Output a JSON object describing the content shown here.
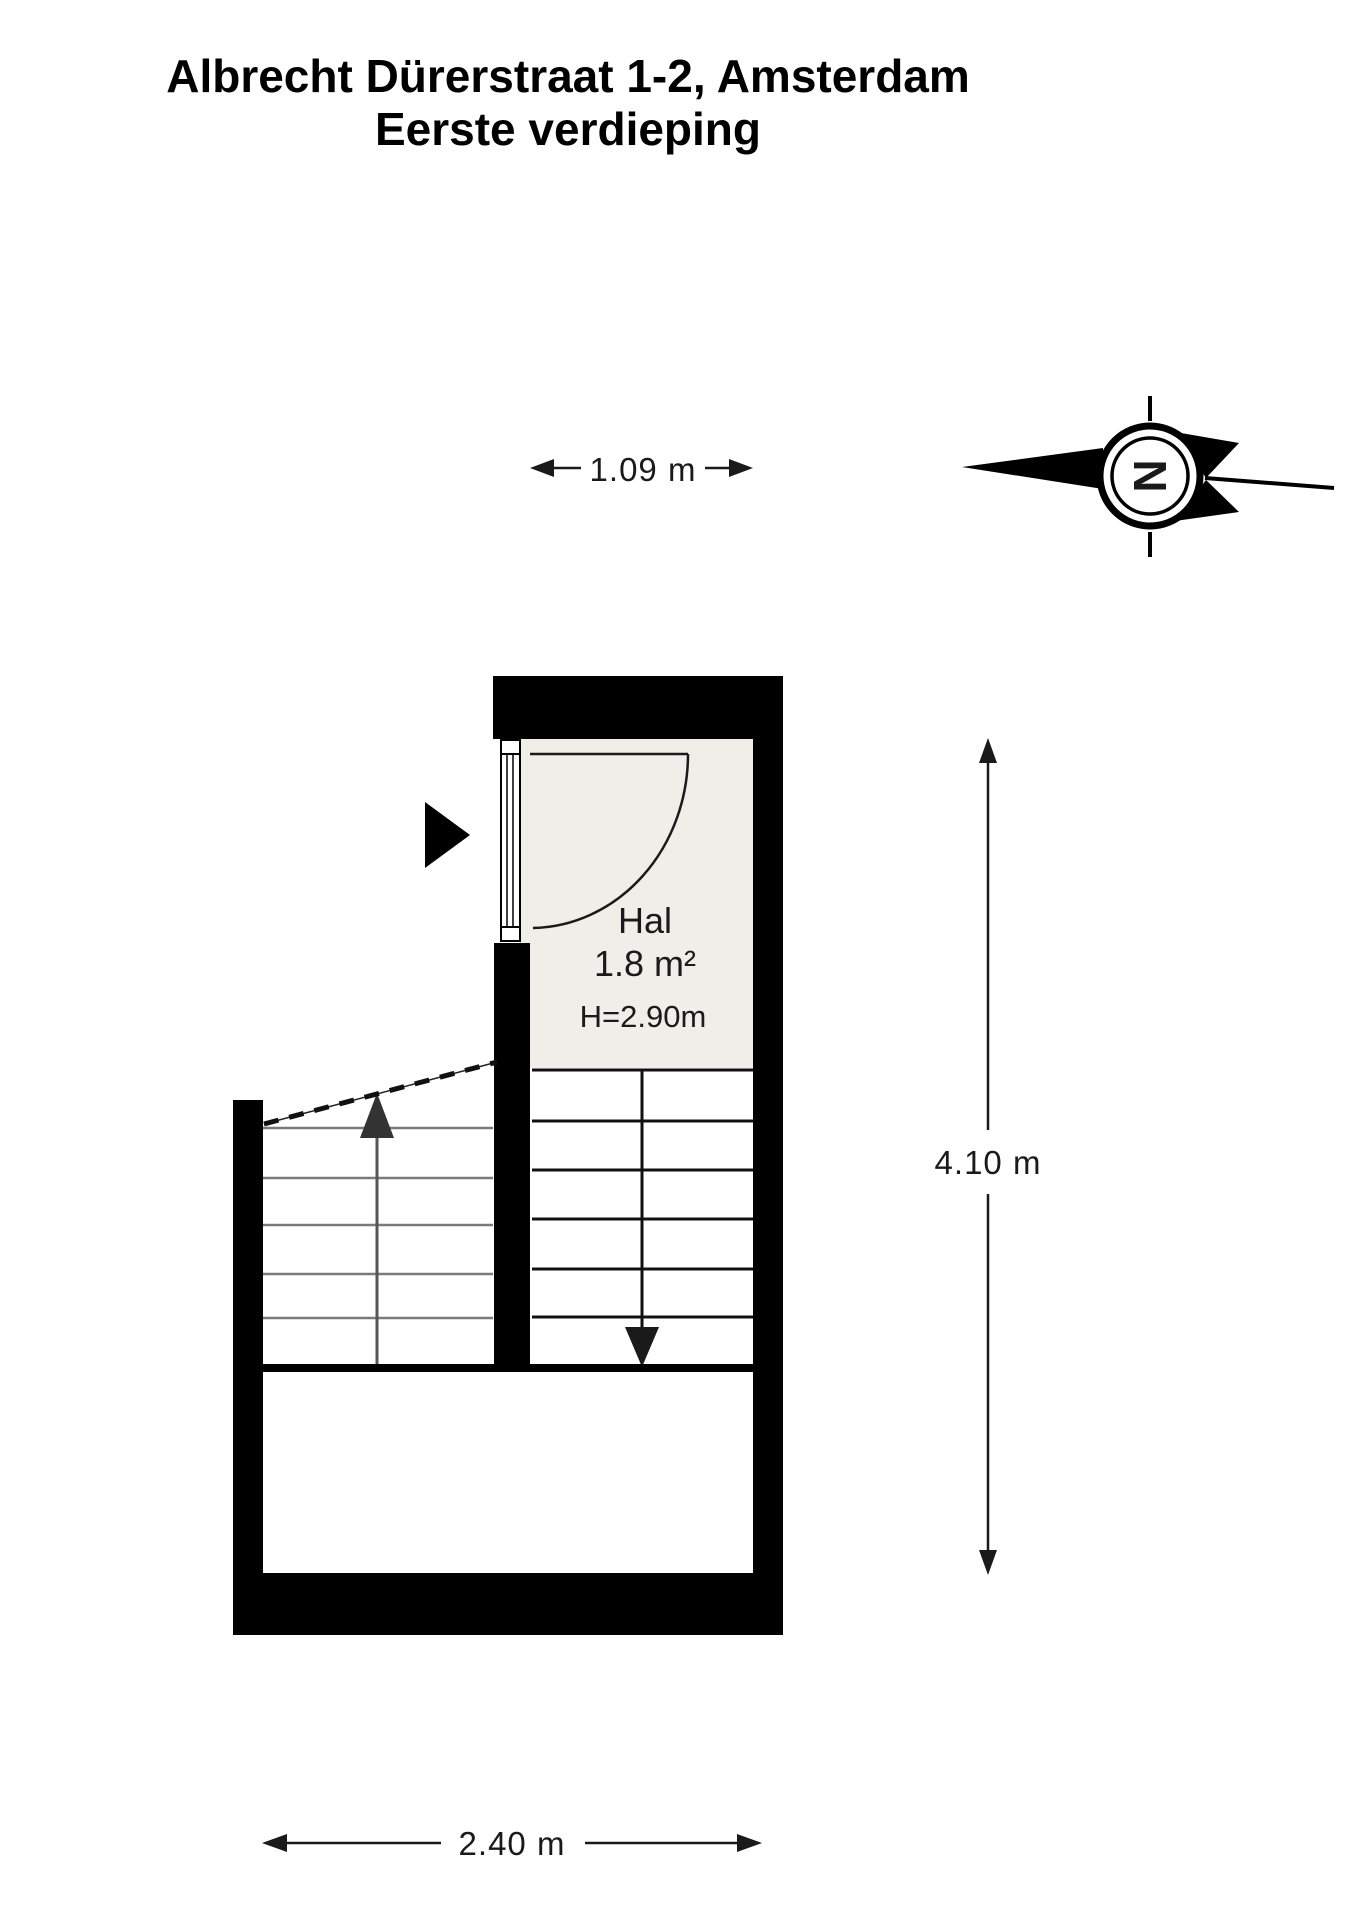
{
  "title": {
    "line1": "Albrecht Dürerstraat 1-2, Amsterdam",
    "line2": "Eerste verdieping"
  },
  "rooms": [
    {
      "name": "Hal",
      "area": "1.8 m²",
      "ceiling_height": "H=2.90m"
    }
  ],
  "dimensions": {
    "hall_width": "1.09 m",
    "total_height": "4.10 m",
    "total_width": "2.40 m"
  },
  "compass": {
    "north_label": "N"
  },
  "colors": {
    "wall": "#000000",
    "room_fill": "#EFEEE8",
    "background": "#FFFFFF",
    "stair_line_gray": "#7A7A7A"
  }
}
